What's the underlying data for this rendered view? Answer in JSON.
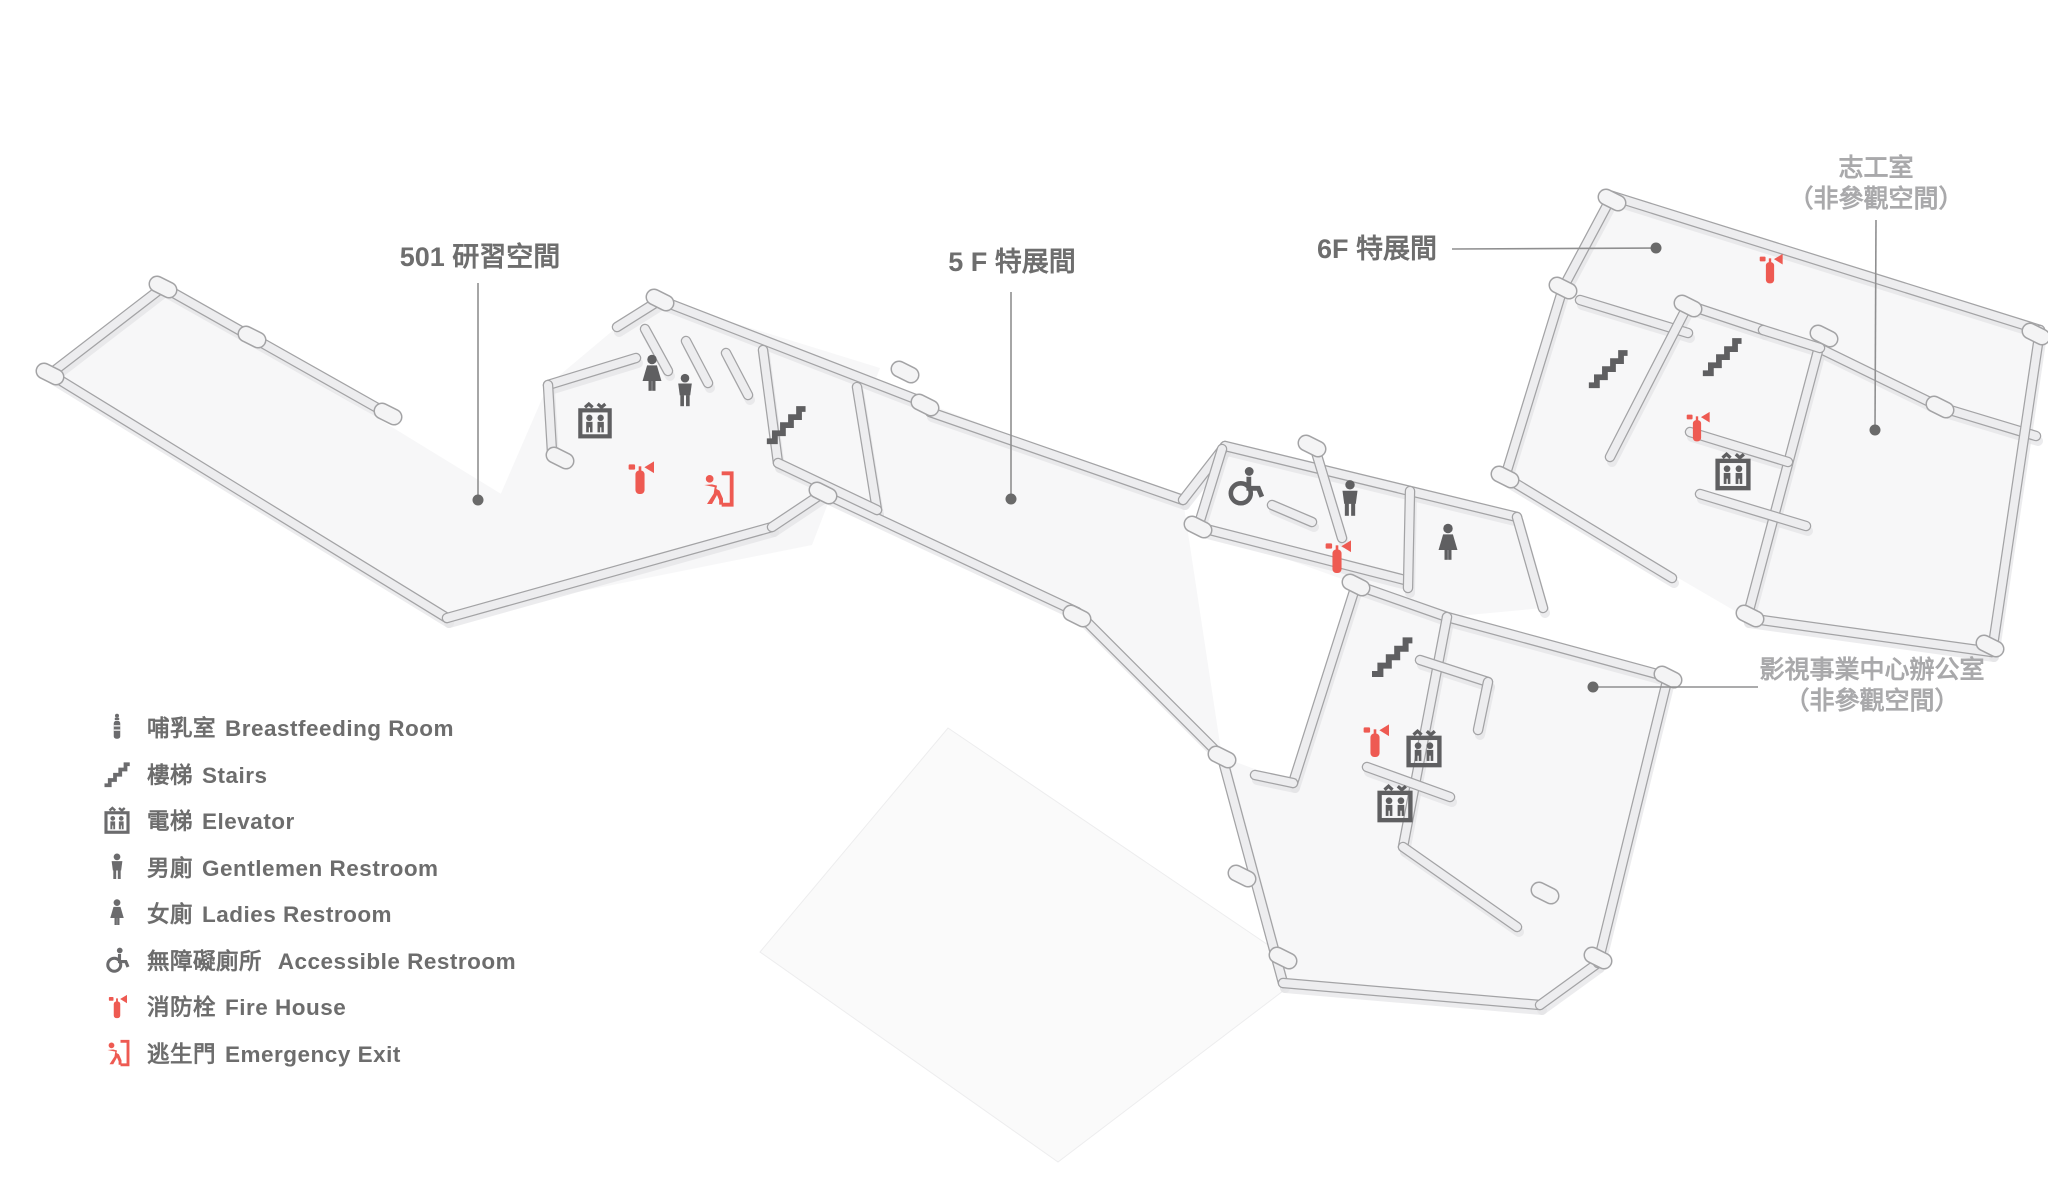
{
  "page": {
    "background": "#ffffff",
    "type": "floor-plan-map"
  },
  "colors": {
    "red": "#ee5a52",
    "icon_gray": "#5f5f61",
    "legend_gray": "#6b6b6d",
    "label_dark": "#6e6e6e",
    "label_gray": "#a9a9ab",
    "leader": "#8f8f90",
    "leader_dot": "#6a6a6a",
    "wall_edge": "#a3a3a5",
    "wall_fill": "#ededef",
    "wall_shadow": "#e3e3e5",
    "pillar_fill": "#f4f4f5",
    "floor": "#f7f7f8",
    "slab": "#fafafa"
  },
  "labels": [
    {
      "id": "area-label-501",
      "lines": [
        "501 研習空間"
      ],
      "tone": "dark",
      "x": 480,
      "y": 266,
      "align": "middle",
      "line_height": 30,
      "leader": {
        "x1": 478,
        "y1": 283,
        "x2": 478,
        "y2": 500
      },
      "dot": {
        "x": 478,
        "y": 500
      }
    },
    {
      "id": "area-label-5f",
      "lines": [
        "5 F 特展間"
      ],
      "tone": "dark",
      "x": 1012,
      "y": 271,
      "align": "middle",
      "line_height": 30,
      "leader": {
        "x1": 1011,
        "y1": 292,
        "x2": 1011,
        "y2": 499
      },
      "dot": {
        "x": 1011,
        "y": 499
      }
    },
    {
      "id": "area-label-6f",
      "lines": [
        "6F 特展間"
      ],
      "tone": "dark",
      "x": 1437,
      "y": 258,
      "align": "end",
      "line_height": 30,
      "leader": {
        "x1": 1452,
        "y1": 249,
        "x2": 1656,
        "y2": 248
      },
      "dot": {
        "x": 1656,
        "y": 248
      }
    },
    {
      "id": "area-label-volunteer-room",
      "lines": [
        "志工室",
        "（非參觀空間）"
      ],
      "tone": "gray",
      "x": 1876,
      "y": 176,
      "align": "middle",
      "line_height": 31,
      "leader": {
        "x1": 1876,
        "y1": 220,
        "x2": 1875,
        "y2": 430
      },
      "dot": {
        "x": 1875,
        "y": 430
      }
    },
    {
      "id": "area-label-film-office",
      "lines": [
        "影視事業中心辦公室",
        "（非參觀空間）"
      ],
      "tone": "gray",
      "x": 1872,
      "y": 678,
      "align": "middle",
      "line_height": 31,
      "leader": {
        "x1": 1758,
        "y1": 687,
        "x2": 1593,
        "y2": 687
      },
      "dot": {
        "x": 1593,
        "y": 687
      }
    }
  ],
  "legend": {
    "items": [
      {
        "icon": "breastfeeding",
        "zh": "哺乳室",
        "en": "Breastfeeding Room",
        "tone": "gray"
      },
      {
        "icon": "stairs",
        "zh": "樓梯",
        "en": "Stairs",
        "tone": "gray"
      },
      {
        "icon": "elevator",
        "zh": "電梯",
        "en": "Elevator",
        "tone": "gray"
      },
      {
        "icon": "gentlemen",
        "zh": "男廁",
        "en": "Gentlemen Restroom",
        "tone": "gray"
      },
      {
        "icon": "ladies",
        "zh": "女廁",
        "en": "Ladies Restroom",
        "tone": "gray"
      },
      {
        "icon": "accessible",
        "zh": "無障礙廁所",
        "en": " Accessible Restroom",
        "tone": "gray"
      },
      {
        "icon": "fire-extinguisher",
        "zh": "消防栓",
        "en": "Fire House",
        "tone": "red"
      },
      {
        "icon": "emergency-exit",
        "zh": "逃生門",
        "en": "Emergency Exit",
        "tone": "red"
      }
    ]
  },
  "markers": [
    {
      "type": "elevator",
      "x": 595,
      "y": 420,
      "size": 40
    },
    {
      "type": "ladies",
      "x": 652,
      "y": 374,
      "size": 42
    },
    {
      "type": "gentlemen",
      "x": 685,
      "y": 391,
      "size": 38
    },
    {
      "type": "fire-extinguisher",
      "x": 640,
      "y": 477,
      "size": 42
    },
    {
      "type": "emergency-exit",
      "x": 717,
      "y": 489,
      "size": 40
    },
    {
      "type": "stairs",
      "x": 786,
      "y": 424,
      "size": 46
    },
    {
      "type": "accessible",
      "x": 1245,
      "y": 486,
      "size": 46
    },
    {
      "type": "gentlemen",
      "x": 1350,
      "y": 499,
      "size": 42
    },
    {
      "type": "ladies",
      "x": 1448,
      "y": 543,
      "size": 42
    },
    {
      "type": "fire-extinguisher",
      "x": 1337,
      "y": 556,
      "size": 42
    },
    {
      "type": "stairs",
      "x": 1392,
      "y": 656,
      "size": 48
    },
    {
      "type": "fire-extinguisher",
      "x": 1375,
      "y": 740,
      "size": 42
    },
    {
      "type": "elevator",
      "x": 1424,
      "y": 748,
      "size": 42
    },
    {
      "type": "elevator",
      "x": 1395,
      "y": 803,
      "size": 42
    },
    {
      "type": "stairs",
      "x": 1608,
      "y": 368,
      "size": 46
    },
    {
      "type": "stairs",
      "x": 1722,
      "y": 356,
      "size": 46
    },
    {
      "type": "fire-extinguisher",
      "x": 1770,
      "y": 268,
      "size": 38
    },
    {
      "type": "fire-extinguisher",
      "x": 1697,
      "y": 426,
      "size": 38
    },
    {
      "type": "elevator",
      "x": 1733,
      "y": 471,
      "size": 42
    }
  ]
}
